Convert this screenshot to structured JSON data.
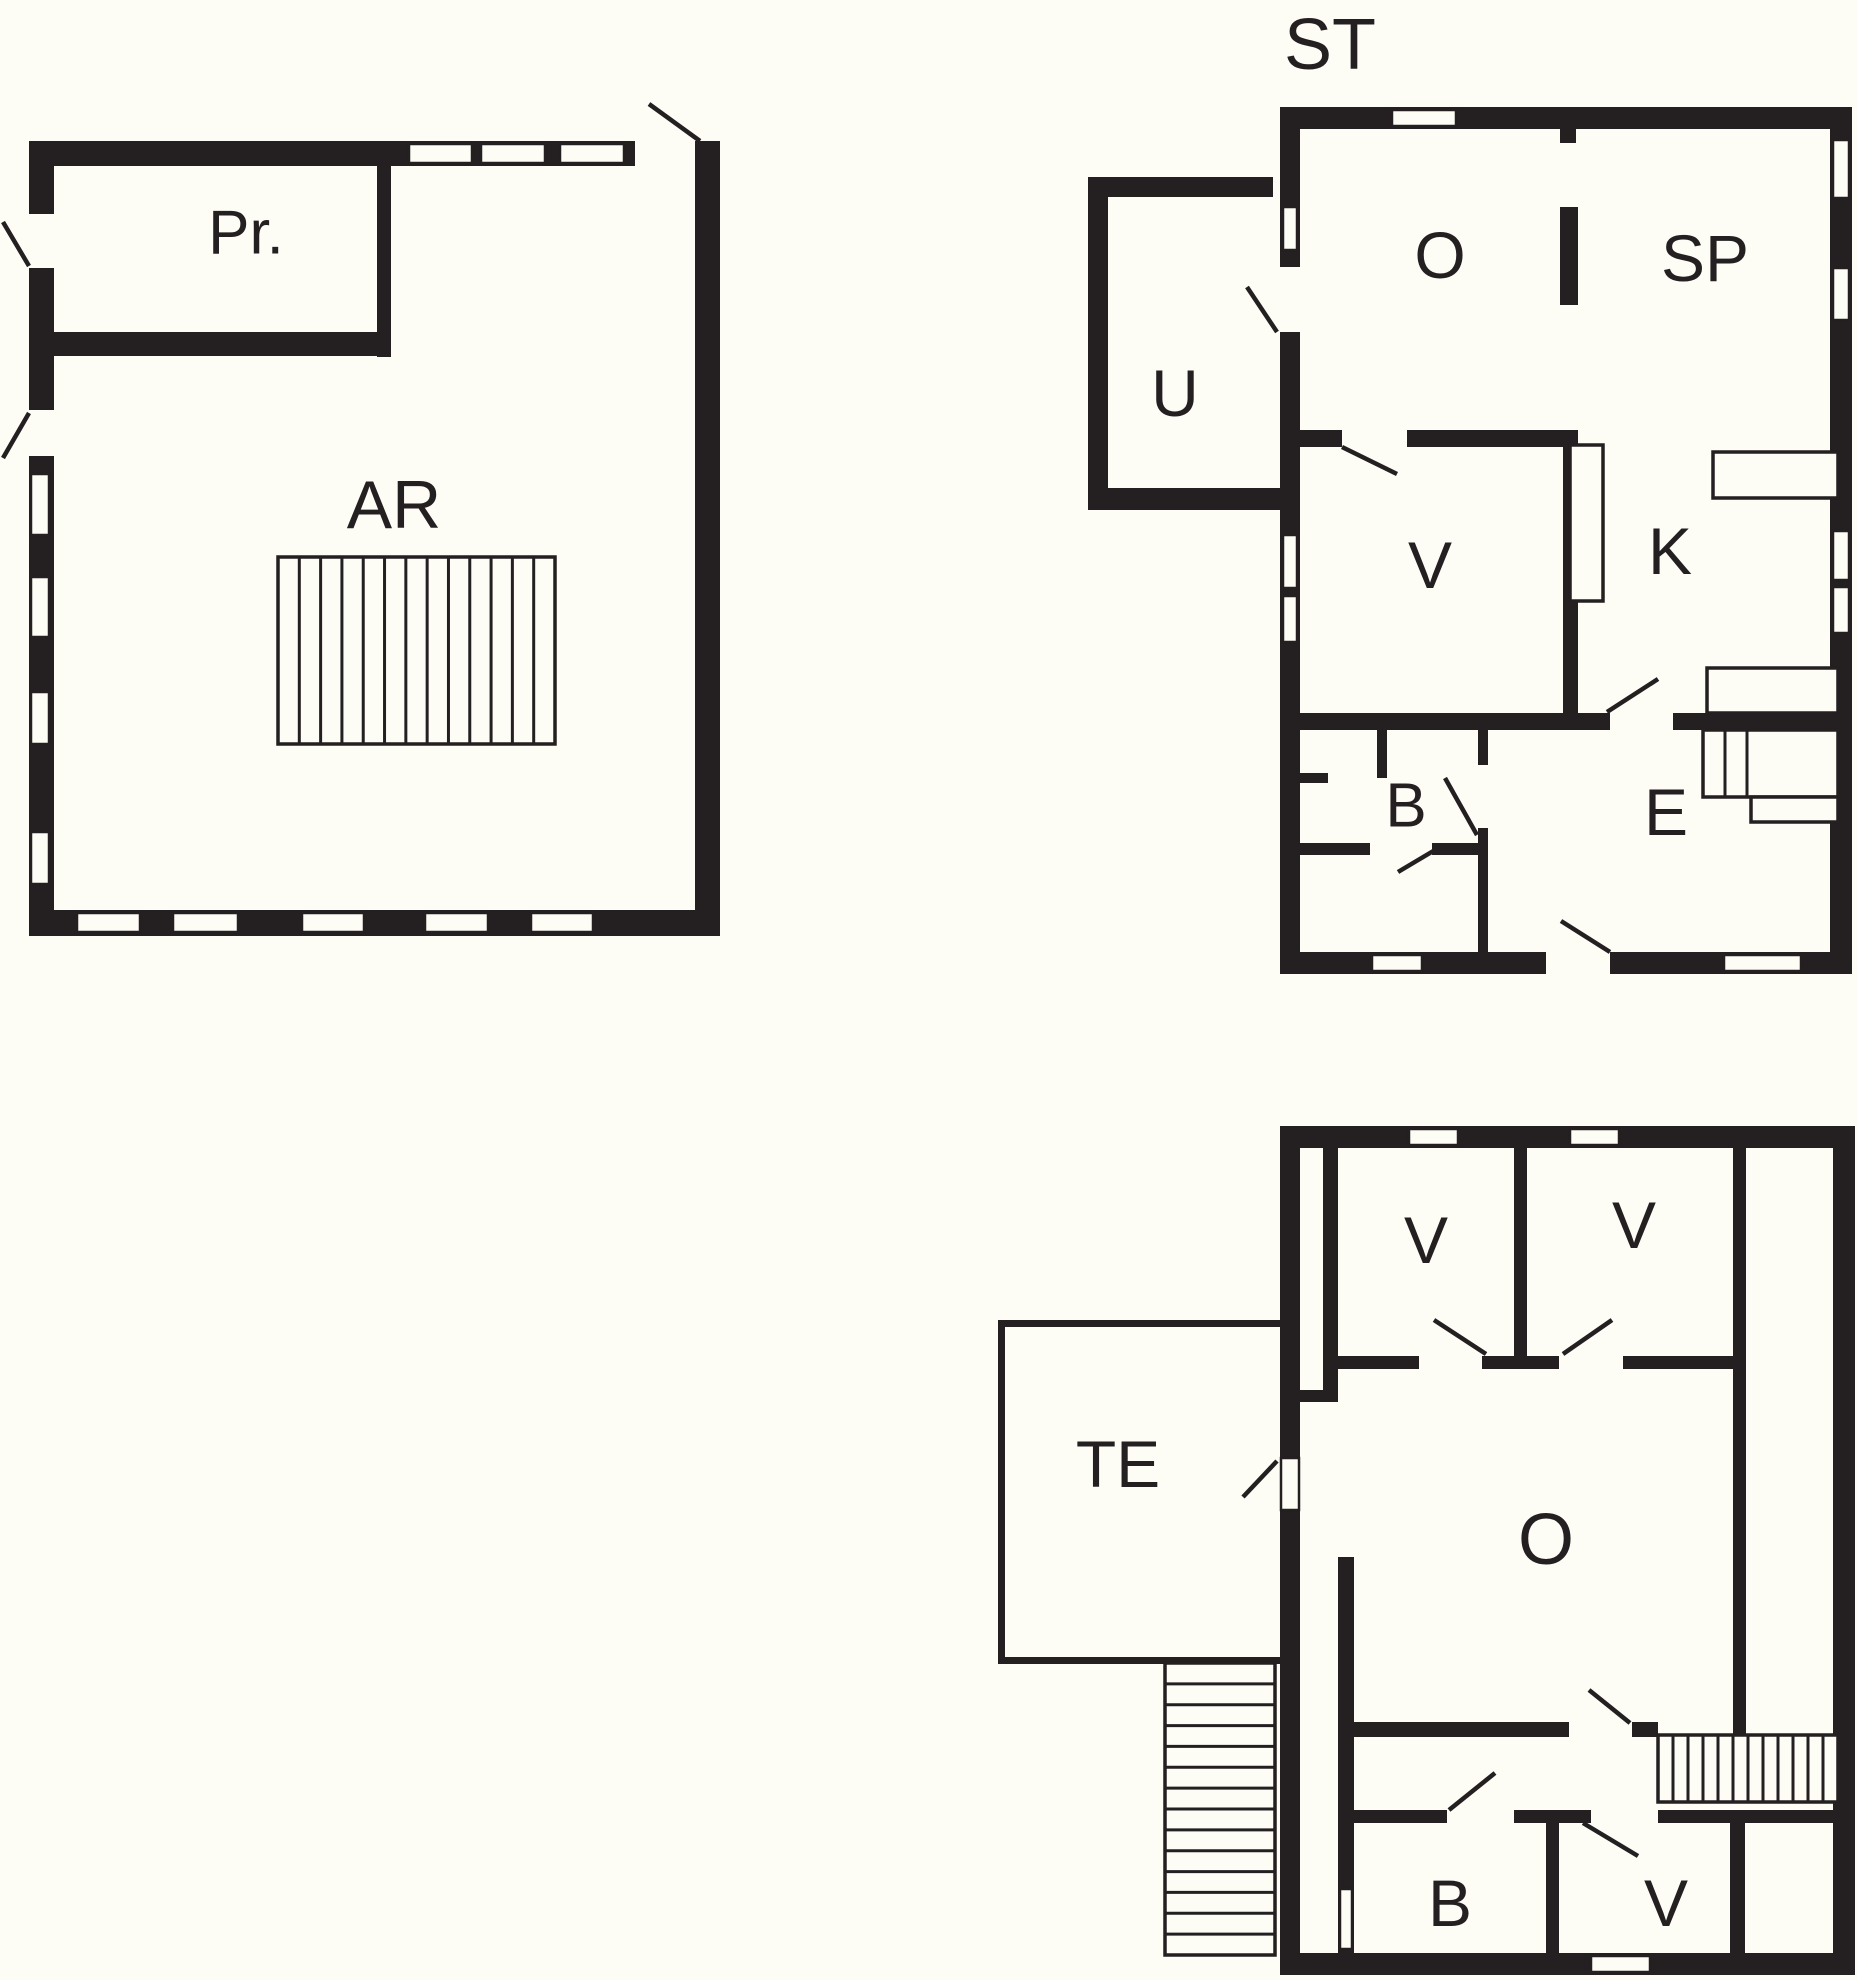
{
  "document": {
    "type": "floor-plan-drawing",
    "sheet_width": 1857,
    "sheet_height": 1980,
    "background_color": "#fdfdf6",
    "wall_color": "#241f21",
    "line_color": "#241f21"
  },
  "plans": [
    {
      "id": "plan-ar-level",
      "labels": [
        {
          "text": "Pr.",
          "x": 246,
          "y": 233,
          "size": 62
        },
        {
          "text": "AR",
          "x": 394,
          "y": 505,
          "size": 68
        }
      ],
      "walls": [
        [
          29,
          141,
          606,
          25
        ],
        [
          700,
          141,
          20,
          25
        ],
        [
          29,
          910,
          691,
          26
        ],
        [
          29,
          141,
          25,
          73
        ],
        [
          29,
          268,
          25,
          142
        ],
        [
          29,
          456,
          25,
          480
        ],
        [
          695,
          141,
          25,
          795
        ],
        [
          377,
          141,
          14,
          216
        ],
        [
          29,
          332,
          362,
          24
        ]
      ],
      "windows": [
        [
          409,
          144,
          63,
          19
        ],
        [
          481,
          144,
          64,
          19
        ],
        [
          560,
          144,
          64,
          19
        ],
        [
          77,
          913,
          63,
          19
        ],
        [
          173,
          913,
          65,
          19
        ],
        [
          302,
          913,
          62,
          19
        ],
        [
          425,
          913,
          63,
          19
        ],
        [
          531,
          913,
          62,
          19
        ],
        [
          31,
          474,
          18,
          61
        ],
        [
          31,
          577,
          18,
          60
        ],
        [
          31,
          692,
          18,
          52
        ],
        [
          31,
          832,
          18,
          52
        ]
      ],
      "door_swings": [
        [
          649,
          104,
          700,
          141
        ],
        [
          3,
          222,
          29,
          266
        ],
        [
          3,
          458,
          29,
          413
        ]
      ],
      "fixtures": [],
      "stairs": [
        {
          "x": 278,
          "y": 557,
          "w": 277,
          "h": 187,
          "dir": "v",
          "treads": 13
        }
      ]
    },
    {
      "id": "plan-st-level",
      "labels": [
        {
          "text": "ST",
          "x": 1330,
          "y": 45,
          "size": 72
        },
        {
          "text": "O",
          "x": 1440,
          "y": 255,
          "size": 66
        },
        {
          "text": "SP",
          "x": 1705,
          "y": 258,
          "size": 66
        },
        {
          "text": "U",
          "x": 1175,
          "y": 393,
          "size": 66
        },
        {
          "text": "V",
          "x": 1430,
          "y": 565,
          "size": 66
        },
        {
          "text": "K",
          "x": 1670,
          "y": 551,
          "size": 66
        },
        {
          "text": "B",
          "x": 1406,
          "y": 806,
          "size": 62
        },
        {
          "text": "E",
          "x": 1666,
          "y": 812,
          "size": 66
        }
      ],
      "walls": [
        [
          1280,
          107,
          572,
          22
        ],
        [
          1830,
          107,
          22,
          867
        ],
        [
          1280,
          952,
          266,
          22
        ],
        [
          1610,
          952,
          242,
          22
        ],
        [
          1280,
          107,
          20,
          160
        ],
        [
          1280,
          332,
          20,
          642
        ],
        [
          1088,
          177,
          185,
          20
        ],
        [
          1088,
          177,
          20,
          333
        ],
        [
          1088,
          488,
          192,
          22
        ],
        [
          1560,
          129,
          16,
          14
        ],
        [
          1560,
          207,
          18,
          98
        ],
        [
          1280,
          430,
          62,
          17
        ],
        [
          1407,
          430,
          158,
          17
        ],
        [
          1563,
          430,
          15,
          287
        ],
        [
          1280,
          713,
          330,
          17
        ],
        [
          1673,
          713,
          179,
          17
        ],
        [
          1377,
          730,
          10,
          48
        ],
        [
          1290,
          773,
          38,
          10
        ],
        [
          1478,
          730,
          10,
          35
        ],
        [
          1478,
          828,
          10,
          124
        ],
        [
          1280,
          843,
          90,
          12
        ],
        [
          1432,
          843,
          56,
          12
        ]
      ],
      "windows": [
        [
          1392,
          110,
          64,
          16
        ],
        [
          1833,
          140,
          16,
          58
        ],
        [
          1833,
          268,
          16,
          52
        ],
        [
          1833,
          531,
          16,
          49
        ],
        [
          1833,
          587,
          16,
          46
        ],
        [
          1372,
          955,
          50,
          16
        ],
        [
          1724,
          955,
          77,
          16
        ],
        [
          1283,
          207,
          14,
          43
        ],
        [
          1283,
          535,
          14,
          53
        ],
        [
          1283,
          596,
          14,
          46
        ]
      ],
      "door_swings": [
        [
          1247,
          287,
          1277,
          332
        ],
        [
          1342,
          447,
          1397,
          474
        ],
        [
          1607,
          712,
          1658,
          679
        ],
        [
          1445,
          778,
          1477,
          835
        ],
        [
          1440,
          847,
          1398,
          872
        ],
        [
          1561,
          921,
          1610,
          952
        ]
      ],
      "fixtures": [
        [
          1570,
          445,
          33,
          156
        ],
        [
          1713,
          452,
          125,
          46
        ],
        [
          1707,
          668,
          131,
          45
        ],
        [
          1751,
          797,
          87,
          25
        ]
      ],
      "stairs": [
        {
          "x": 1703,
          "y": 730,
          "w": 135,
          "h": 67,
          "dir": "v",
          "lines": [
            1725,
            1747
          ]
        }
      ]
    },
    {
      "id": "plan-upper-level",
      "labels": [
        {
          "text": "V",
          "x": 1426,
          "y": 1240,
          "size": 66
        },
        {
          "text": "V",
          "x": 1634,
          "y": 1225,
          "size": 66
        },
        {
          "text": "TE",
          "x": 1118,
          "y": 1464,
          "size": 66
        },
        {
          "text": "O",
          "x": 1546,
          "y": 1540,
          "size": 72
        },
        {
          "text": "B",
          "x": 1450,
          "y": 1903,
          "size": 66
        },
        {
          "text": "V",
          "x": 1666,
          "y": 1903,
          "size": 66
        }
      ],
      "walls": [
        [
          1280,
          1126,
          575,
          22
        ],
        [
          1833,
          1126,
          22,
          849
        ],
        [
          1280,
          1953,
          575,
          22
        ],
        [
          1280,
          1126,
          20,
          332
        ],
        [
          1280,
          1510,
          20,
          445
        ],
        [
          1323,
          1126,
          15,
          274
        ],
        [
          1296,
          1390,
          42,
          12
        ],
        [
          1514,
          1148,
          13,
          221
        ],
        [
          1733,
          1148,
          13,
          590
        ],
        [
          1323,
          1356,
          96,
          13
        ],
        [
          1482,
          1356,
          77,
          13
        ],
        [
          1623,
          1356,
          110,
          13
        ],
        [
          1338,
          1722,
          231,
          15
        ],
        [
          1632,
          1722,
          26,
          15
        ],
        [
          1658,
          1810,
          180,
          13
        ],
        [
          1338,
          1810,
          109,
          13
        ],
        [
          1514,
          1810,
          77,
          13
        ],
        [
          1546,
          1823,
          13,
          132
        ],
        [
          1730,
          1823,
          15,
          132
        ],
        [
          1338,
          1557,
          16,
          398
        ],
        [
          998,
          1320,
          282,
          7
        ],
        [
          998,
          1320,
          7,
          344
        ],
        [
          998,
          1657,
          282,
          7
        ]
      ],
      "windows": [
        [
          1409,
          1129,
          49,
          16
        ],
        [
          1570,
          1129,
          49,
          16
        ],
        [
          1591,
          1956,
          59,
          16
        ],
        [
          1281,
          1458,
          18,
          52
        ],
        [
          1340,
          1889,
          12,
          60
        ]
      ],
      "door_swings": [
        [
          1434,
          1320,
          1486,
          1354
        ],
        [
          1563,
          1354,
          1612,
          1320
        ],
        [
          1589,
          1690,
          1630,
          1723
        ],
        [
          1449,
          1810,
          1495,
          1773
        ],
        [
          1583,
          1823,
          1638,
          1856
        ],
        [
          1243,
          1497,
          1277,
          1461
        ]
      ],
      "fixtures": [],
      "stairs": [
        {
          "x": 1658,
          "y": 1735,
          "w": 180,
          "h": 67,
          "dir": "v",
          "treads": 12
        },
        {
          "x": 1165,
          "y": 1663,
          "w": 110,
          "h": 292,
          "dir": "h",
          "treads": 14
        }
      ]
    }
  ]
}
